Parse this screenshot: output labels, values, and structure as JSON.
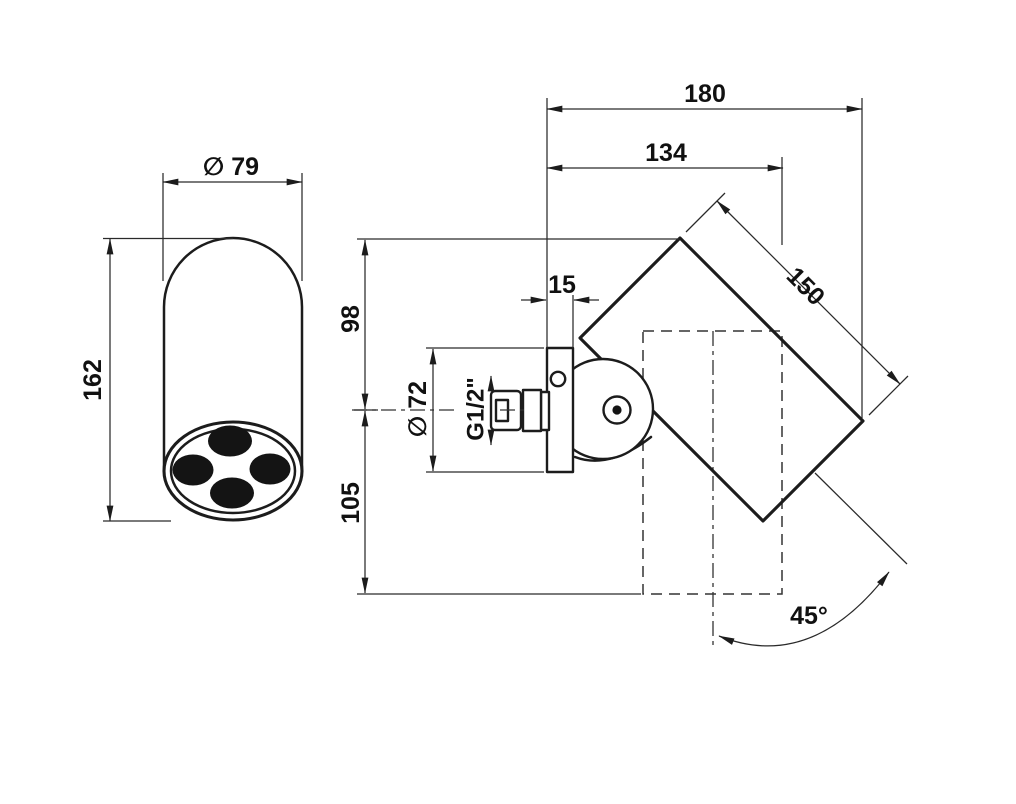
{
  "drawing": {
    "subject": "wall-mounted swivel shower head - dimensioned technical drawing, front and side views",
    "background_color": "#ffffff",
    "line_color": "#1c1c1c",
    "front_view": {
      "nozzle_count": 4,
      "labels": {
        "diameter": "∅ 79",
        "height": "162"
      }
    },
    "side_view": {
      "labels": {
        "total_depth": "180",
        "depth_to_body": "134",
        "body_length": "150",
        "plate_thickness": "15",
        "above_axis": "98",
        "below_axis": "105",
        "plate_diameter": "∅ 72",
        "thread": "G1/2\"",
        "swivel_angle": "45°"
      }
    }
  }
}
